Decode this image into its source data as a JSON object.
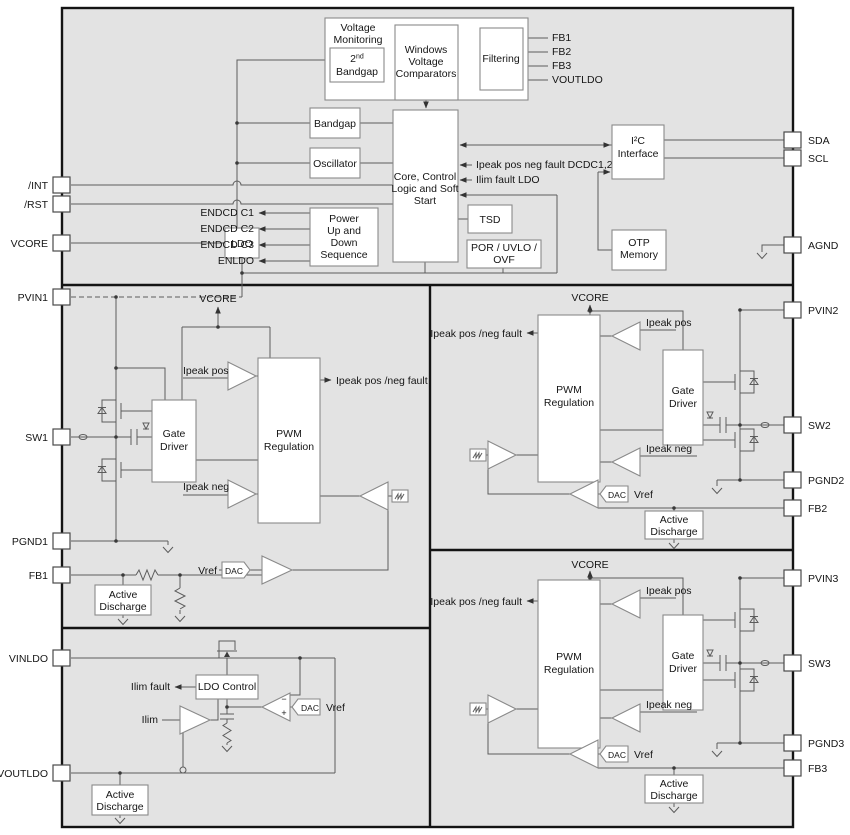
{
  "colors": {
    "chip_background": "#e3e3e3",
    "block_fill": "#ffffff",
    "outline": "#141414",
    "wire": "#5c5c5c"
  },
  "pins": {
    "left": [
      {
        "label": "/INT"
      },
      {
        "label": "/RST"
      },
      {
        "label": "VCORE"
      },
      {
        "label": "PVIN1"
      },
      {
        "label": "SW1"
      },
      {
        "label": "PGND1"
      },
      {
        "label": "FB1"
      },
      {
        "label": "VINLDO"
      },
      {
        "label": "VOUTLDO"
      }
    ],
    "right": [
      {
        "label": "SDA"
      },
      {
        "label": "SCL"
      },
      {
        "label": "AGND"
      },
      {
        "label": "PVIN2"
      },
      {
        "label": "SW2"
      },
      {
        "label": "PGND2"
      },
      {
        "label": "FB2"
      },
      {
        "label": "PVIN3"
      },
      {
        "label": "SW3"
      },
      {
        "label": "PGND3"
      },
      {
        "label": "FB3"
      }
    ]
  },
  "top": {
    "vm_1": "Voltage",
    "vm_2": "Monitoring",
    "bg2_num": "2",
    "bg2_sup": "nd",
    "bg2_word": "Bandgap",
    "wvc_1": "Windows",
    "wvc_2": "Voltage",
    "wvc_3": "Comparators",
    "filtering": "Filtering",
    "fbout_1": "FB1",
    "fbout_2": "FB2",
    "fbout_3": "FB3",
    "fbout_4": "VOUTLDO",
    "bandgap": "Bandgap",
    "oscillator": "Oscillator",
    "core_1": "Core, Control",
    "core_2": "Logic and Soft",
    "core_3": "Start",
    "bus_fault": "Ipeak pos neg fault DCDC1,2,3",
    "bus_ilim": "Ilim fault LDO",
    "en_1": "ENDCD C1",
    "en_2": "ENDCD C2",
    "en_3": "ENDCD C3",
    "en_4": "ENLDO",
    "seq_1": "Power",
    "seq_2": "Up and",
    "seq_3": "Down",
    "seq_4": "Sequence",
    "tsd": "TSD",
    "por_1": "POR / UVLO /",
    "por_2": "OVF",
    "i2c_1": "I²C",
    "i2c_2": "Interface",
    "otp_1": "OTP",
    "otp_2": "Memory",
    "ldo": "LDO"
  },
  "dcdc1": {
    "vcore": "VCORE",
    "ipeak_pos": "Ipeak pos",
    "ipeak_neg": "Ipeak neg",
    "fault_out": "Ipeak pos /neg fault",
    "pwm_1": "PWM",
    "pwm_2": "Regulation",
    "gate_1": "Gate",
    "gate_2": "Driver",
    "dac": "DAC",
    "vref": "Vref",
    "ad_1": "Active",
    "ad_2": "Discharge"
  },
  "dcdc2": {
    "vcore": "VCORE",
    "ipeak_pos": "Ipeak pos",
    "ipeak_neg": "Ipeak neg",
    "fault_out": "Ipeak pos /neg fault",
    "pwm_1": "PWM",
    "pwm_2": "Regulation",
    "gate_1": "Gate",
    "gate_2": "Driver",
    "dac": "DAC",
    "vref": "Vref",
    "ad_1": "Active",
    "ad_2": "Discharge"
  },
  "dcdc3": {
    "vcore": "VCORE",
    "ipeak_pos": "Ipeak pos",
    "ipeak_neg": "Ipeak neg",
    "fault_out": "Ipeak pos /neg fault",
    "pwm_1": "PWM",
    "pwm_2": "Regulation",
    "gate_1": "Gate",
    "gate_2": "Driver",
    "dac": "DAC",
    "vref": "Vref",
    "ad_1": "Active",
    "ad_2": "Discharge"
  },
  "ldo_sec": {
    "ilim_fault": "Ilim fault",
    "control": "LDO Control",
    "ilim": "Ilim",
    "minus": "−",
    "plus": "+",
    "dac": "DAC",
    "vref": "Vref",
    "ad_1": "Active",
    "ad_2": "Discharge"
  }
}
